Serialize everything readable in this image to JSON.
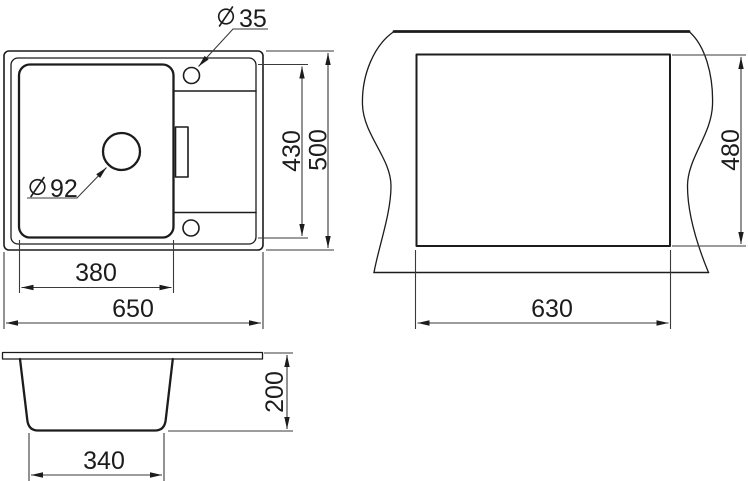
{
  "colors": {
    "background": "#ffffff",
    "line": "#1c1c1c",
    "dim_line": "#3a3a3a"
  },
  "views": {
    "top": {
      "name": "sink top view",
      "faucet_hole": {
        "symbol": "diameter",
        "value": "35"
      },
      "drain_hole": {
        "symbol": "diameter",
        "value": "92"
      },
      "dims": {
        "inner_length": "430",
        "overall_depth": "500",
        "bowl_width": "380",
        "overall_width": "650"
      }
    },
    "cutout": {
      "name": "countertop cutout view",
      "dims": {
        "depth": "480",
        "width": "630"
      }
    },
    "side": {
      "name": "sink side section view",
      "dims": {
        "bowl_depth": "200",
        "bowl_bottom_width": "340"
      }
    }
  }
}
